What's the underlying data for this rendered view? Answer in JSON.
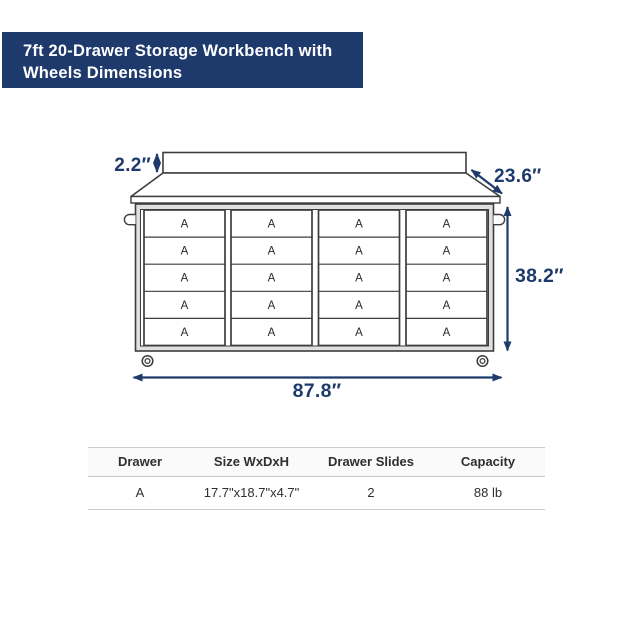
{
  "header": {
    "title_line1": "7ft 20-Drawer Storage Workbench with",
    "title_line2": "Wheels Dimensions"
  },
  "colors": {
    "banner_bg": "#1e3a6d",
    "banner_text": "#ffffff",
    "dimension_accent": "#1e3a6d",
    "line_art": "#3d3d3d"
  },
  "diagram": {
    "drawer_label": "A",
    "drawer_columns": 4,
    "drawer_rows": 5,
    "total_drawers": 20,
    "dimensions": {
      "backsplash_height": "2.2″",
      "worktop_depth": "23.6″",
      "overall_height": "38.2″",
      "overall_width": "87.8″"
    }
  },
  "spec_table": {
    "headers": [
      "Drawer",
      "Size WxDxH",
      "Drawer Slides",
      "Capacity"
    ],
    "rows": [
      {
        "drawer": "A",
        "size": "17.7\"x18.7\"x4.7\"",
        "slides": "2",
        "capacity": "88 lb"
      }
    ]
  }
}
